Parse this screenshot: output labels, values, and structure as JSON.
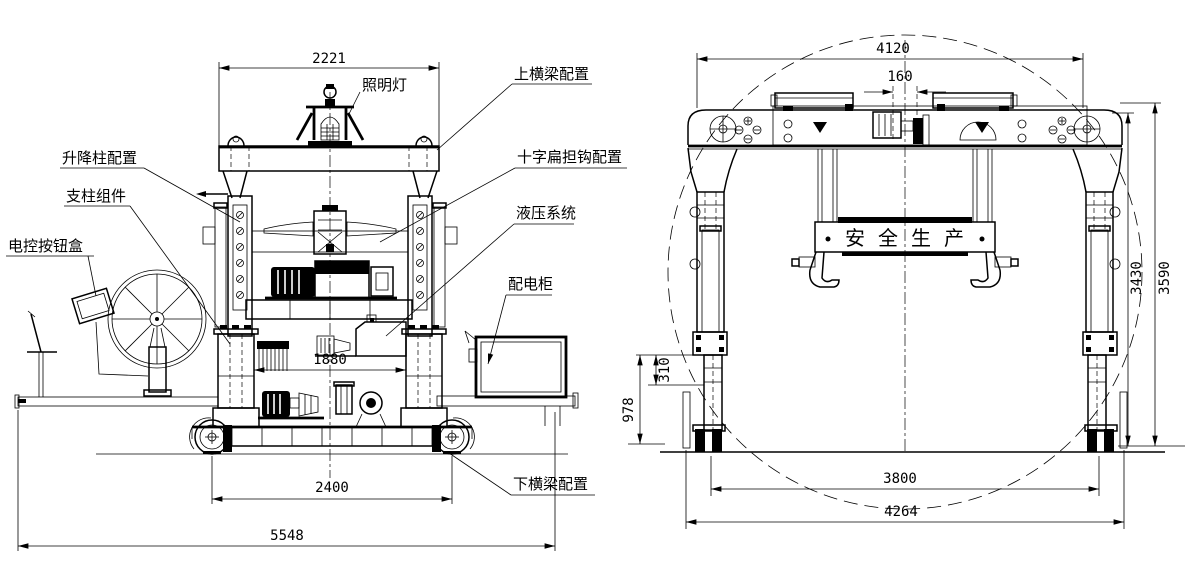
{
  "drawing": {
    "background": "#ffffff",
    "line_color": "#000000",
    "left_view": {
      "callouts": {
        "lamp": "照明灯",
        "upper_beam": "上横梁配置",
        "lift_column": "升降柱配置",
        "support_column": "支柱组件",
        "control_box": "电控按钮盒",
        "cross_spreader": "十字扁担钩配置",
        "hydraulic": "液压系统",
        "power_cabinet": "配电柜",
        "lower_beam": "下横梁配置"
      },
      "dims": {
        "top_width": "2221",
        "column_span": "1880",
        "wheelbase": "2400",
        "overall_width": "5548"
      }
    },
    "right_view": {
      "banner": "安全生产",
      "dims": {
        "top_width": "4120",
        "center_offset": "160",
        "height_inner": "3430",
        "height_outer": "3590",
        "step": "310",
        "leg": "978",
        "track_gauge": "3800",
        "overall_width": "4264"
      }
    }
  }
}
